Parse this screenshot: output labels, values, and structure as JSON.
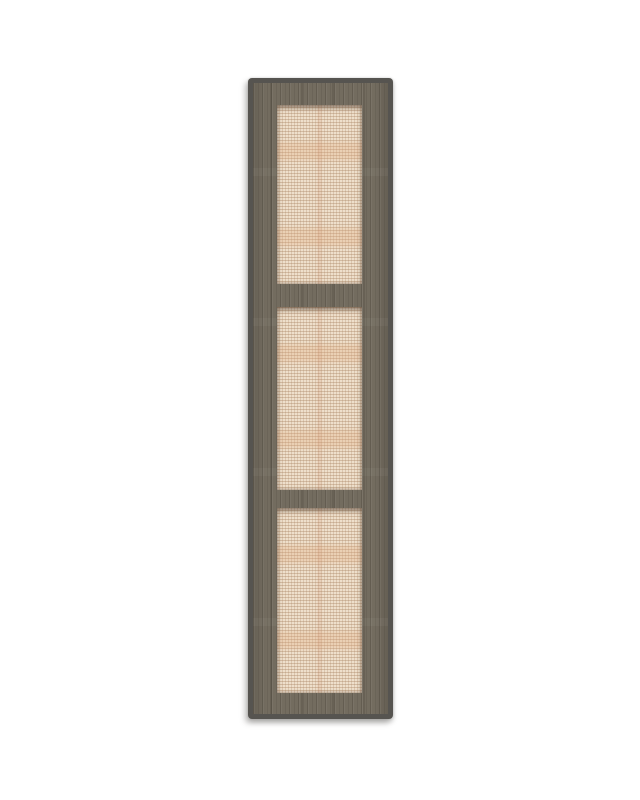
{
  "scene": {
    "type": "product-image",
    "alt": "Tall cabinet door with a gray-brown woodgrain frame and three recessed woven rattan panels, shown on a plain white background",
    "background": "#ffffff"
  },
  "door": {
    "panel_count": 3,
    "panels": [
      {
        "position": "top"
      },
      {
        "position": "middle"
      },
      {
        "position": "bottom"
      }
    ]
  },
  "colors": {
    "background": "#ffffff",
    "edge": "#565450",
    "wood_base": "#736C5F",
    "wood_grain_dark": "#5A554A",
    "wood_grain_light": "#878070",
    "rattan_base": "#EEDFCB",
    "rattan_weave": "#D2B79C",
    "rattan_streak": "#E6BB96",
    "panel_shadow": "rgba(80,62,48,0.55)",
    "drop_shadow": "rgba(120,118,115,0.45)"
  }
}
